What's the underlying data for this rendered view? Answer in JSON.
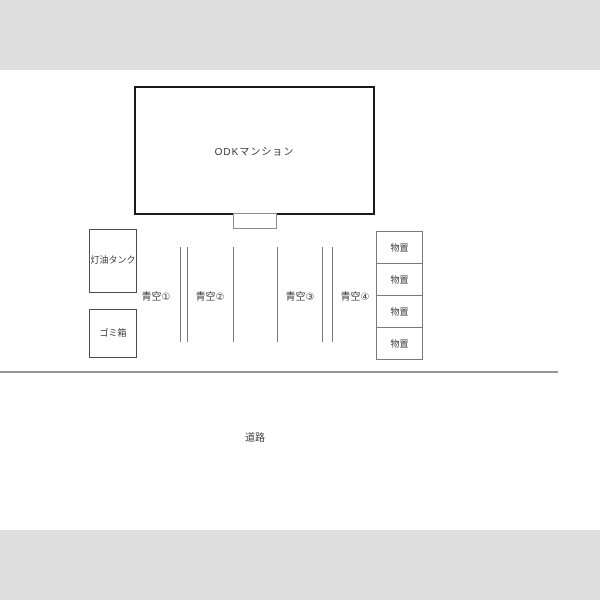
{
  "colors": {
    "letterbox_gray": "#dfdfdf",
    "building_outline": "#1a1a1a",
    "thin_line_gray": "#7a7a7a",
    "road_line_gray": "#969696",
    "background": "#ffffff"
  },
  "plan": {
    "building": {
      "label": "ODKマンション"
    },
    "kerosene_tank": {
      "label": "灯油タンク"
    },
    "trash_box": {
      "label": "ゴミ箱"
    },
    "parking": {
      "spaces": [
        {
          "label": "青空①"
        },
        {
          "label": "青空②"
        },
        {
          "label": "青空③"
        },
        {
          "label": "青空④"
        }
      ]
    },
    "storage": {
      "sheds": [
        {
          "label": "物置"
        },
        {
          "label": "物置"
        },
        {
          "label": "物置"
        },
        {
          "label": "物置"
        }
      ]
    },
    "road": {
      "label": "道路"
    }
  }
}
